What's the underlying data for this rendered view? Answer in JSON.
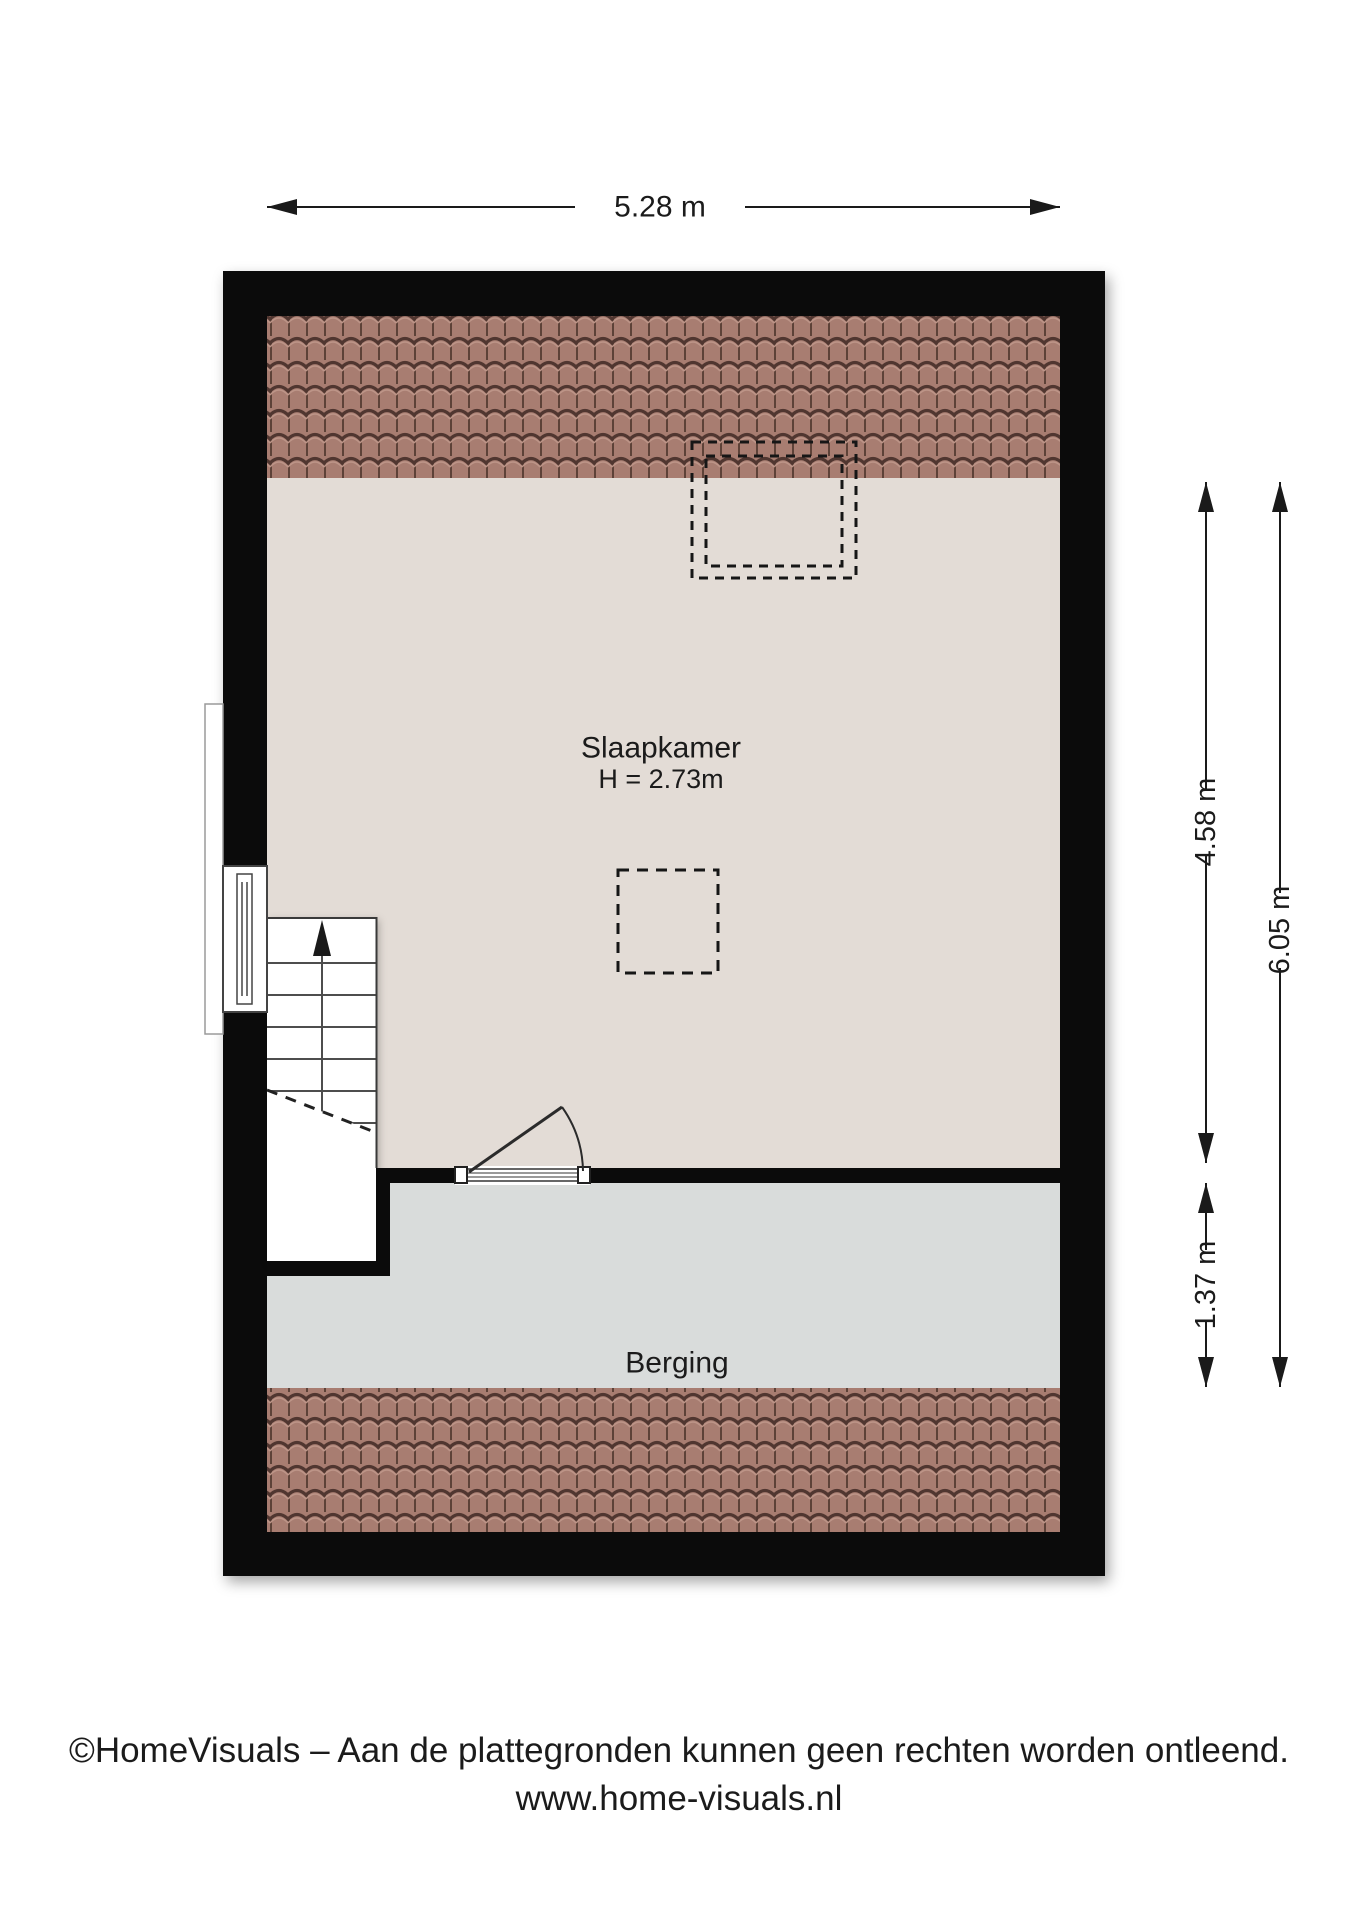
{
  "dimensions": {
    "width_top": "5.28 m",
    "slaapkamer_depth": "4.58 m",
    "total_depth": "6.05 m",
    "berging_depth": "1.37 m"
  },
  "rooms": {
    "slaapkamer": {
      "name": "Slaapkamer",
      "ceiling_height": "H = 2.73m"
    },
    "berging": {
      "name": "Berging"
    }
  },
  "footer": {
    "copyright": "©HomeVisuals – Aan de plattegronden kunnen geen rechten worden ontleend.",
    "website": "www.home-visuals.nl"
  },
  "colors": {
    "wall": "#0b0b0b",
    "slaapkamer_floor": "#e3dcd6",
    "berging_floor": "#d9dcdb",
    "roof_tile_base": "#a87d71",
    "roof_tile_groove": "#5d4238",
    "roof_tile_wave": "#503630",
    "roof_tile_highlight": "#bd9588",
    "line_dark": "#1a1a1a"
  }
}
